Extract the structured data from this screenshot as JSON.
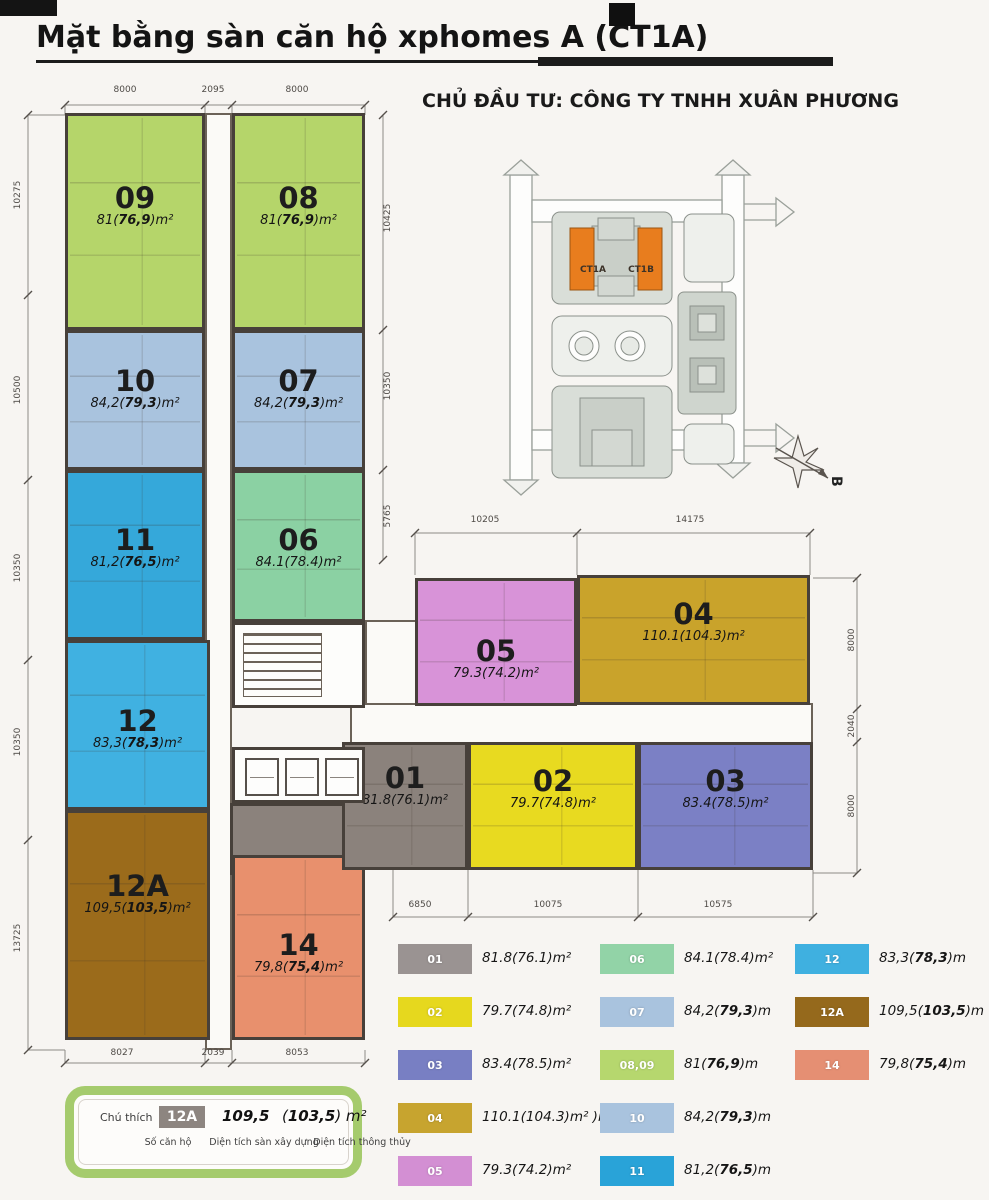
{
  "header": {
    "title": "Mặt bằng sàn căn hộ xphomes A (CT1A)",
    "subtitle": "CHỦ ĐẦU TƯ: CÔNG TY TNHH XUÂN PHƯƠNG"
  },
  "site_plan": {
    "building_a": "CT1A",
    "building_b": "CT1B",
    "north_label": "B",
    "highlight_color": "#e87d1e"
  },
  "apartments": [
    {
      "id": "09",
      "num": "09",
      "pre": "81(",
      "bold": "76,9",
      "suf": ")m²",
      "color": "#b5d56a",
      "x": 65,
      "y": 113,
      "w": 140,
      "h": 217,
      "ly": 67
    },
    {
      "id": "08",
      "num": "08",
      "pre": "81(",
      "bold": "76,9",
      "suf": ")m²",
      "color": "#b5d56a",
      "x": 232,
      "y": 113,
      "w": 133,
      "h": 217,
      "ly": 67
    },
    {
      "id": "10",
      "num": "10",
      "pre": "84,2(",
      "bold": "79,3",
      "suf": ")m²",
      "color": "#a9c3de",
      "x": 65,
      "y": 330,
      "w": 140,
      "h": 140,
      "ly": 33
    },
    {
      "id": "07",
      "num": "07",
      "pre": "84,2(",
      "bold": "79,3",
      "suf": ")m²",
      "color": "#a9c3de",
      "x": 232,
      "y": 330,
      "w": 133,
      "h": 140,
      "ly": 33
    },
    {
      "id": "11",
      "num": "11",
      "pre": "81,2(",
      "bold": "76,5",
      "suf": ")m²",
      "color": "#35a8da",
      "x": 65,
      "y": 470,
      "w": 140,
      "h": 170,
      "ly": 52
    },
    {
      "id": "06",
      "num": "06",
      "pre": "84.1(78.4)m²",
      "bold": "",
      "suf": "",
      "color": "#8bd1a3",
      "x": 232,
      "y": 470,
      "w": 133,
      "h": 152,
      "ly": 52
    },
    {
      "id": "12",
      "num": "12",
      "pre": "83,3(",
      "bold": "78,3",
      "suf": ")m²",
      "color": "#40b1e1",
      "x": 65,
      "y": 640,
      "w": 145,
      "h": 170,
      "ly": 63
    },
    {
      "id": "12A",
      "num": "12A",
      "pre": "109,5(",
      "bold": "103,5",
      "suf": ")m²",
      "color": "#9b6b1b",
      "x": 65,
      "y": 810,
      "w": 145,
      "h": 230,
      "ly": 58
    },
    {
      "id": "14",
      "num": "14",
      "pre": "79,8(",
      "bold": "75,4",
      "suf": ")m²",
      "color": "#e8906d",
      "x": 232,
      "y": 855,
      "w": 133,
      "h": 185,
      "ly": 72
    },
    {
      "id": "05",
      "num": "05",
      "pre": "79.3(74.2)m²",
      "bold": "",
      "suf": "",
      "color": "#d893d8",
      "x": 415,
      "y": 578,
      "w": 162,
      "h": 128,
      "ly": 55
    },
    {
      "id": "04",
      "num": "04",
      "pre": "110.1(104.3)m²",
      "bold": "",
      "suf": "",
      "color": "#c9a32b",
      "x": 577,
      "y": 575,
      "w": 233,
      "h": 130,
      "ly": 21
    },
    {
      "id": "01",
      "num": "01",
      "pre": "81.8(76.1)m²",
      "bold": "",
      "suf": "",
      "color": "#8b827c",
      "x": 342,
      "y": 742,
      "w": 126,
      "h": 128,
      "ly": 18
    },
    {
      "id": "02",
      "num": "02",
      "pre": "79.7(74.8)m²",
      "bold": "",
      "suf": "",
      "color": "#e8da20",
      "x": 468,
      "y": 742,
      "w": 170,
      "h": 128,
      "ly": 21
    },
    {
      "id": "03",
      "num": "03",
      "pre": "83.4(78.5)m²",
      "bold": "",
      "suf": "",
      "color": "#7b80c5",
      "x": 638,
      "y": 742,
      "w": 175,
      "h": 128,
      "ly": 21
    }
  ],
  "blocks": [
    {
      "name": "tower-corridor",
      "x": 205,
      "y": 113,
      "w": 27,
      "h": 937,
      "color": "#fbfaf7",
      "border": "2px solid #6b6258",
      "z": 1
    },
    {
      "name": "corridor-junction",
      "x": 365,
      "y": 620,
      "w": 52,
      "h": 125,
      "color": "#fbfaf7",
      "border": "2px solid #6b6258",
      "z": 1
    },
    {
      "name": "wing-corridor",
      "x": 350,
      "y": 703,
      "w": 463,
      "h": 42,
      "color": "#fbfaf7",
      "border": "2px solid #6b6258",
      "z": 1
    },
    {
      "name": "apartment-01-annex",
      "x": 230,
      "y": 803,
      "w": 135,
      "h": 72,
      "color": "#8b827c",
      "border": "3px solid #47403a",
      "z": 2
    },
    {
      "name": "apartment-06-annex",
      "x": 232,
      "y": 596,
      "w": 60,
      "h": 44,
      "color": "#8bd1a3",
      "border": "3px solid #47403a",
      "z": 2
    },
    {
      "name": "stair-core",
      "x": 232,
      "y": 622,
      "w": 133,
      "h": 86,
      "color": "#fdfdfb",
      "border": "3px solid #47403a",
      "z": 4,
      "type": "stairs"
    },
    {
      "name": "lift-core",
      "x": 232,
      "y": 747,
      "w": 133,
      "h": 56,
      "color": "#fdfdfb",
      "border": "3px solid #47403a",
      "z": 4,
      "type": "lifts"
    }
  ],
  "dimensions": [
    {
      "t": "8000",
      "x": 125,
      "y": 90
    },
    {
      "t": "2095",
      "x": 213,
      "y": 90
    },
    {
      "t": "8000",
      "x": 297,
      "y": 90
    },
    {
      "t": "10275",
      "x": 18,
      "y": 195,
      "r": 1
    },
    {
      "t": "10500",
      "x": 18,
      "y": 390,
      "r": 1
    },
    {
      "t": "10350",
      "x": 18,
      "y": 568,
      "r": 1
    },
    {
      "t": "10350",
      "x": 18,
      "y": 742,
      "r": 1
    },
    {
      "t": "13725",
      "x": 18,
      "y": 938,
      "r": 1
    },
    {
      "t": "10425",
      "x": 388,
      "y": 218,
      "r": 1
    },
    {
      "t": "10350",
      "x": 388,
      "y": 386,
      "r": 1
    },
    {
      "t": "5765",
      "x": 388,
      "y": 516,
      "r": 1
    },
    {
      "t": "10205",
      "x": 485,
      "y": 520
    },
    {
      "t": "14175",
      "x": 690,
      "y": 520
    },
    {
      "t": "8000",
      "x": 852,
      "y": 640,
      "r": 1
    },
    {
      "t": "2040",
      "x": 852,
      "y": 726,
      "r": 1
    },
    {
      "t": "8000",
      "x": 852,
      "y": 806,
      "r": 1
    },
    {
      "t": "6850",
      "x": 420,
      "y": 905
    },
    {
      "t": "10075",
      "x": 548,
      "y": 905
    },
    {
      "t": "10575",
      "x": 718,
      "y": 905
    },
    {
      "t": "8027",
      "x": 122,
      "y": 1053
    },
    {
      "t": "2039",
      "x": 213,
      "y": 1053
    },
    {
      "t": "8053",
      "x": 297,
      "y": 1053
    }
  ],
  "legend": {
    "columns": [
      [
        {
          "id": "01",
          "color": "#9a9392",
          "pre": "81.8(76.1)m²",
          "bold": "",
          "suf": ""
        },
        {
          "id": "02",
          "color": "#e6d81e",
          "pre": "79.7(74.8)m²",
          "bold": "",
          "suf": ""
        },
        {
          "id": "03",
          "color": "#787fc3",
          "pre": "83.4(78.5)m²",
          "bold": "",
          "suf": ""
        },
        {
          "id": "04",
          "color": "#c7a42f",
          "pre": "110.1(104.3)m² )m²",
          "bold": "",
          "suf": ""
        },
        {
          "id": "05",
          "color": "#d38fd3",
          "pre": "79.3(74.2)m²",
          "bold": "",
          "suf": ""
        }
      ],
      [
        {
          "id": "06",
          "color": "#92d3a7",
          "pre": "84.1(78.4)m²",
          "bold": "",
          "suf": ""
        },
        {
          "id": "07",
          "color": "#a9c3de",
          "pre": "84,2(",
          "bold": "79,3",
          "suf": ")m"
        },
        {
          "id": "08,09",
          "color": "#b6d76e",
          "pre": "81(",
          "bold": "76,9",
          "suf": ")m"
        },
        {
          "id": "10",
          "color": "#a9c3de",
          "pre": "84,2(",
          "bold": "79,3",
          "suf": ")m"
        },
        {
          "id": "11",
          "color": "#29a3d8",
          "pre": "81,2(",
          "bold": "76,5",
          "suf": ")m"
        }
      ],
      [
        {
          "id": "12",
          "color": "#3fb0e0",
          "pre": "83,3(",
          "bold": "78,3",
          "suf": ")m"
        },
        {
          "id": "12A",
          "color": "#95691c",
          "pre": "109,5(",
          "bold": "103,5",
          "suf": ")m"
        },
        {
          "id": "14",
          "color": "#e58f73",
          "pre": "79,8(",
          "bold": "75,4",
          "suf": ")m"
        }
      ]
    ]
  },
  "note": {
    "label": "Chú thích",
    "sample_id": "12A",
    "sample_gross": "109,5",
    "net_pre": "(",
    "net_bold": "103,5",
    "net_suf": ") m²",
    "caption_id": "Số căn hộ",
    "caption_gross": "Diện tích sàn xây dựng",
    "caption_net": "Diện tích thông thủy"
  }
}
